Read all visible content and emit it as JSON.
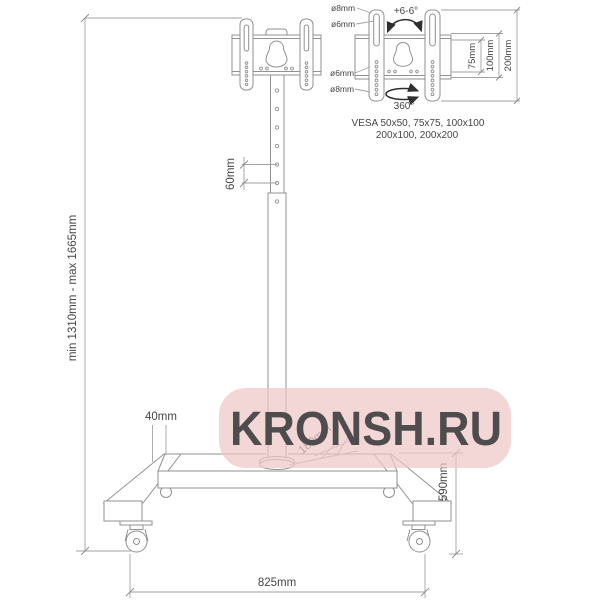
{
  "watermark": {
    "text": "KRONSH.RU",
    "bg_color": "#eec6c6",
    "text_color": "#ffffff"
  },
  "dimensions": {
    "height_range": "min 1310mm - max 1665mm",
    "hole_spacing": "60mm",
    "leg_tube": "40mm",
    "pole_offset": "180mm",
    "base_depth": "590mm",
    "base_width": "825mm"
  },
  "vesa_detail": {
    "tilt": "+6-6°",
    "swivel": "360°",
    "hole_labels": [
      "ø8mm",
      "ø6mm",
      "ø6mm",
      "ø8mm"
    ],
    "dim_labels": [
      "75mm",
      "100mm",
      "200mm"
    ],
    "compat_line1": "VESA 50x50, 75x75, 100x100",
    "compat_line2": "200x100, 200x200"
  },
  "colors": {
    "line": "#919191",
    "dimension_line": "#a2a2a2",
    "text": "#454545",
    "arrow": "#2f2f2f"
  }
}
